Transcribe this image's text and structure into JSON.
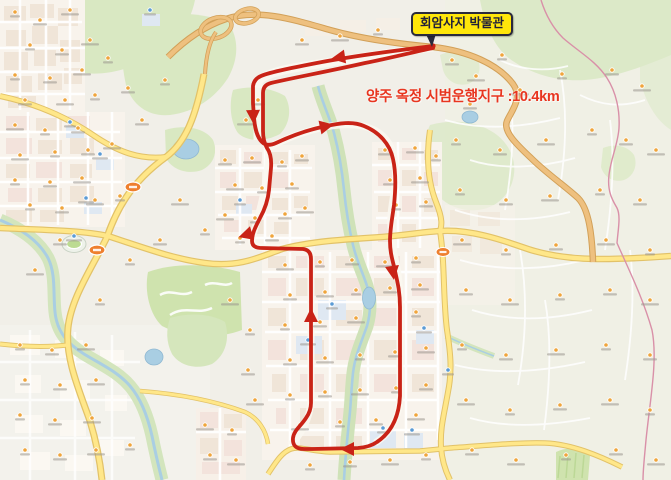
{
  "callout": {
    "label": "회암사지 박물관"
  },
  "route_info": {
    "text": "양주 옥정 시범운행지구 :10.4km",
    "area": "양주 옥정 시범운행지구",
    "distance": "10.4km"
  },
  "route": {
    "description": "one-way red loop with out-and-back spur to museum",
    "arrow_count": 7,
    "color": "#c92317"
  },
  "colors": {
    "route_red": "#c92317",
    "callout_bg": "#ffe60a",
    "callout_border": "#2a2a3c",
    "callout_text": "#20203a",
    "route_info_text": "#e8351f",
    "road_yellow": "#ffe789",
    "highway_tan": "#eec07f",
    "water_blue": "#a9cee3",
    "forest_green": "#d9e8c2",
    "boundary_pink": "#d990a8",
    "land_base": "#f1efe8"
  }
}
